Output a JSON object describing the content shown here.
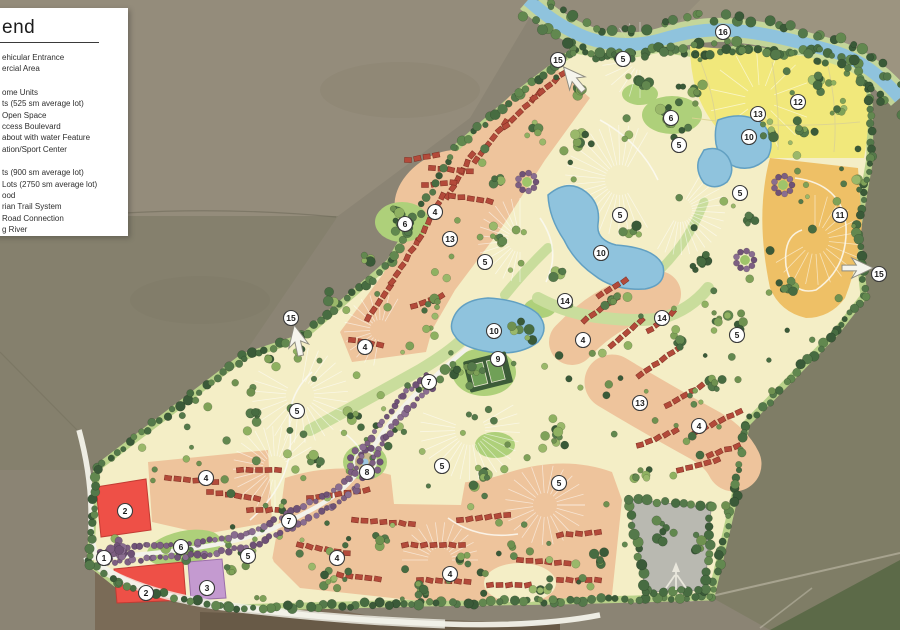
{
  "legend": {
    "title": "end",
    "groups": [
      [
        "ehicular Entrance",
        "ercial Area"
      ],
      [
        "ome Units",
        "ts (525 sm average lot)",
        "Open Space",
        "ccess Boulevard",
        "about with water Feature",
        "ation/Sport Center"
      ],
      [
        "ts (900 sm average lot)",
        "Lots (2750 sm average lot)",
        "ood",
        "rian Trail System",
        "Road Connection",
        "g River"
      ]
    ]
  },
  "colors": {
    "farmland_base": "#8b8474",
    "farmland_light": "#948c7b",
    "farmland_mid": "#85806d",
    "farmland_olive": "#7f7d66",
    "farmland_tan": "#9c9480",
    "farmland_dark_green": "#5c6a48",
    "farmland_brown": "#7a6b57",
    "farmland_brown2": "#685a47",
    "site_cream": "#f4eec6",
    "site_edge_green": "#b9d28a",
    "open_space_green": "#aed07a",
    "trail_green": "#c9dd9c",
    "villa_peach": "#eec49c",
    "estate_yellow": "#f1e87b",
    "lots_orange": "#eec066",
    "commercial_red": "#ee5047",
    "townhome_purple": "#c49ad0",
    "lake_blue": "#8fc3dd",
    "lake_edge": "#62a0c2",
    "road_white": "#f3f2ea",
    "gray_parcel": "#b9b9b1",
    "sport_dark": "#3c5c38",
    "sport_court": "#70a057",
    "house_red": "#b34a3a",
    "tree_purple": "#7d5f82",
    "marker_bg": "#ffffff",
    "marker_border": "#3a3a3a",
    "marker_text": "#1a1a1a"
  },
  "map": {
    "markers": [
      {
        "n": 1,
        "x": 104,
        "y": 558
      },
      {
        "n": 2,
        "x": 125,
        "y": 511
      },
      {
        "n": 2,
        "x": 146,
        "y": 593
      },
      {
        "n": 3,
        "x": 207,
        "y": 588
      },
      {
        "n": 4,
        "x": 206,
        "y": 478
      },
      {
        "n": 4,
        "x": 337,
        "y": 558
      },
      {
        "n": 4,
        "x": 450,
        "y": 574
      },
      {
        "n": 4,
        "x": 365,
        "y": 347
      },
      {
        "n": 4,
        "x": 435,
        "y": 212
      },
      {
        "n": 4,
        "x": 583,
        "y": 340
      },
      {
        "n": 4,
        "x": 699,
        "y": 426
      },
      {
        "n": 5,
        "x": 248,
        "y": 556
      },
      {
        "n": 5,
        "x": 297,
        "y": 411
      },
      {
        "n": 5,
        "x": 442,
        "y": 466
      },
      {
        "n": 5,
        "x": 485,
        "y": 262
      },
      {
        "n": 5,
        "x": 559,
        "y": 483
      },
      {
        "n": 5,
        "x": 620,
        "y": 215
      },
      {
        "n": 5,
        "x": 623,
        "y": 59
      },
      {
        "n": 5,
        "x": 679,
        "y": 145
      },
      {
        "n": 5,
        "x": 737,
        "y": 335
      },
      {
        "n": 5,
        "x": 740,
        "y": 193
      },
      {
        "n": 6,
        "x": 181,
        "y": 547
      },
      {
        "n": 6,
        "x": 405,
        "y": 224
      },
      {
        "n": 6,
        "x": 671,
        "y": 118
      },
      {
        "n": 7,
        "x": 289,
        "y": 521
      },
      {
        "n": 7,
        "x": 429,
        "y": 382
      },
      {
        "n": 8,
        "x": 367,
        "y": 472
      },
      {
        "n": 9,
        "x": 498,
        "y": 359
      },
      {
        "n": 10,
        "x": 494,
        "y": 331
      },
      {
        "n": 10,
        "x": 601,
        "y": 253
      },
      {
        "n": 10,
        "x": 749,
        "y": 137
      },
      {
        "n": 11,
        "x": 840,
        "y": 215
      },
      {
        "n": 12,
        "x": 798,
        "y": 102
      },
      {
        "n": 13,
        "x": 450,
        "y": 239
      },
      {
        "n": 13,
        "x": 640,
        "y": 403
      },
      {
        "n": 13,
        "x": 758,
        "y": 114
      },
      {
        "n": 14,
        "x": 565,
        "y": 301
      },
      {
        "n": 14,
        "x": 662,
        "y": 318
      },
      {
        "n": 15,
        "x": 291,
        "y": 318
      },
      {
        "n": 15,
        "x": 558,
        "y": 60
      },
      {
        "n": 15,
        "x": 879,
        "y": 274
      },
      {
        "n": 16,
        "x": 723,
        "y": 32
      }
    ],
    "direction_arrows": [
      {
        "x": 297,
        "y": 338,
        "angle": -12
      },
      {
        "x": 572,
        "y": 77,
        "angle": -40
      },
      {
        "x": 860,
        "y": 268,
        "angle": 90
      }
    ],
    "north_arrow": {
      "x": 676,
      "y": 577
    }
  }
}
